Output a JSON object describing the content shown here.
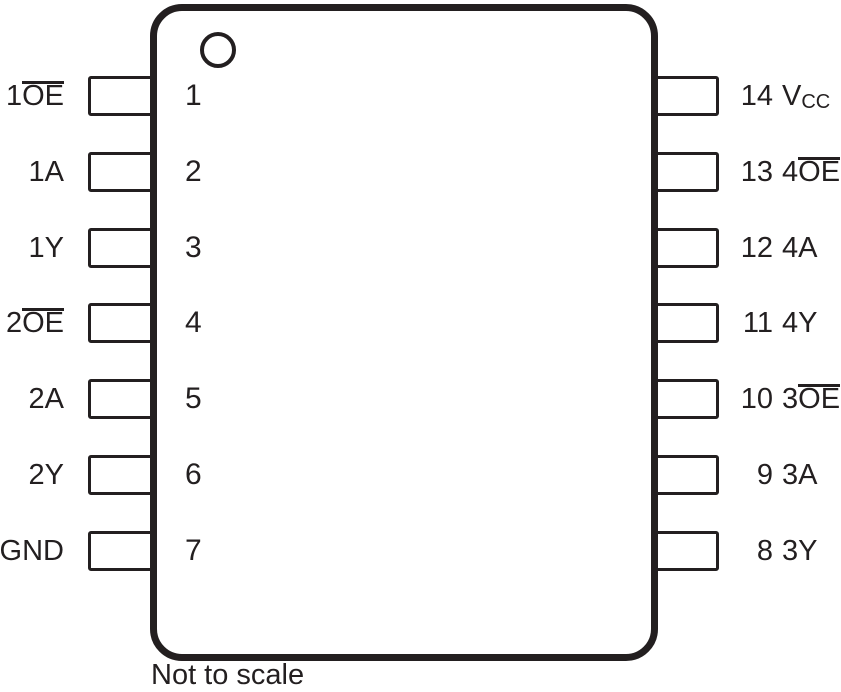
{
  "note": "Not to scale",
  "colors": {
    "ink": "#231f20",
    "background": "#ffffff"
  },
  "package": {
    "type": "14-pin dual in-line pinout diagram",
    "pin1_indicator": "circle",
    "left_pins": [
      {
        "number": "1",
        "name_base": "1",
        "name_bar": "OE",
        "name_sub": ""
      },
      {
        "number": "2",
        "name_base": "1A",
        "name_bar": "",
        "name_sub": ""
      },
      {
        "number": "3",
        "name_base": "1Y",
        "name_bar": "",
        "name_sub": ""
      },
      {
        "number": "4",
        "name_base": "2",
        "name_bar": "OE",
        "name_sub": ""
      },
      {
        "number": "5",
        "name_base": "2A",
        "name_bar": "",
        "name_sub": ""
      },
      {
        "number": "6",
        "name_base": "2Y",
        "name_bar": "",
        "name_sub": ""
      },
      {
        "number": "7",
        "name_base": "GND",
        "name_bar": "",
        "name_sub": ""
      }
    ],
    "right_pins": [
      {
        "number": "14",
        "name_base": "V",
        "name_bar": "",
        "name_sub": "CC"
      },
      {
        "number": "13",
        "name_base": "4",
        "name_bar": "OE",
        "name_sub": ""
      },
      {
        "number": "12",
        "name_base": "4A",
        "name_bar": "",
        "name_sub": ""
      },
      {
        "number": "11",
        "name_base": "4Y",
        "name_bar": "",
        "name_sub": ""
      },
      {
        "number": "10",
        "name_base": "3",
        "name_bar": "OE",
        "name_sub": ""
      },
      {
        "number": "9",
        "name_base": "3A",
        "name_bar": "",
        "name_sub": ""
      },
      {
        "number": "8",
        "name_base": "3Y",
        "name_bar": "",
        "name_sub": ""
      }
    ]
  }
}
